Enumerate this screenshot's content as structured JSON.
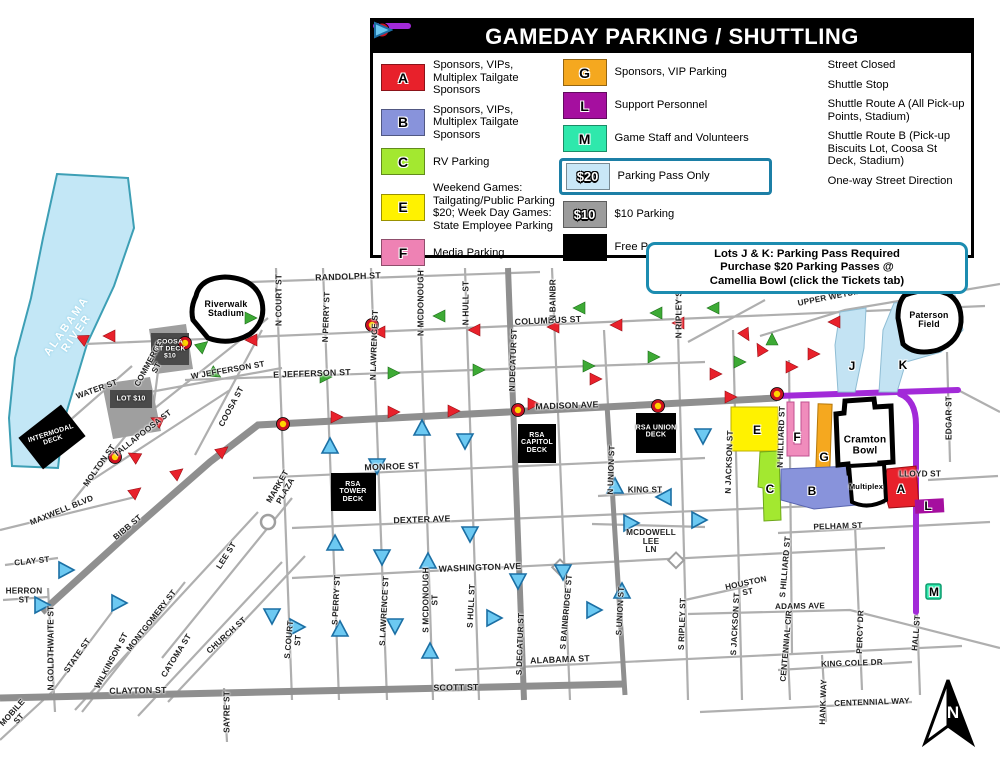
{
  "legend": {
    "title": "GAMEDAY PARKING / SHUTTLING",
    "col1": [
      {
        "letter": "A",
        "color": "#e8212b",
        "text": "Sponsors, VIPs, Multiplex Tailgate Sponsors"
      },
      {
        "letter": "B",
        "color": "#8893db",
        "text": "Sponsors, VIPs, Multiplex Tailgate Sponsors"
      },
      {
        "letter": "C",
        "color": "#a3e830",
        "text": "RV Parking"
      },
      {
        "letter": "E",
        "color": "#fff200",
        "text": "Weekend Games: Tailgating/Public Parking $20; Week Day Games: State Employee Parking"
      },
      {
        "letter": "F",
        "color": "#ee82b4",
        "text": "Media Parking"
      }
    ],
    "col2": [
      {
        "letter": "G",
        "color": "#f5a81f",
        "text": "Sponsors, VIP Parking"
      },
      {
        "letter": "L",
        "color": "#a50f9f",
        "text": "Support Personnel"
      },
      {
        "letter": "M",
        "color": "#2fe8ac",
        "text": "Game Staff and Volunteers"
      },
      {
        "letter": "$20",
        "color": "#c9e7f7",
        "text": "Parking Pass Only"
      },
      {
        "letter": "$10",
        "color": "#9c9c9c",
        "text": "$10 Parking"
      },
      {
        "letter": "",
        "color": "#000000",
        "text": "Free Public Parking"
      }
    ],
    "col3": [
      {
        "text": "Street Closed"
      },
      {
        "text": "Shuttle Stop"
      },
      {
        "text": "Shuttle Route A (All Pick-up Points, Stadium)"
      },
      {
        "text": "Shuttle Route B (Pick-up Biscuits Lot, Coosa St Deck, Stadium)"
      },
      {
        "text": "One-way Street Direction"
      }
    ]
  },
  "note": {
    "text": "Lots J & K: Parking Pass Required\nPurchase $20 Parking Passes @\nCamellia Bowl (click the Tickets tab)"
  },
  "colors": {
    "street_closed": "#a22ad8",
    "route_a": "#e8212b",
    "route_b": "#3daa35",
    "one_way": "#6cc9f2",
    "river": "#c3e7f6",
    "lot_jk": "#c3e3f3",
    "road": "#afafaf"
  },
  "streets": [
    "RANDOLPH ST",
    "COLUMBUS ST",
    "E JEFFERSON ST",
    "W JEFFERSON ST",
    "MADISON AVE",
    "MONROE ST",
    "DEXTER AVE",
    "WASHINGTON AVE",
    "ALABAMA ST",
    "SCOTT ST",
    "CLAYTON ST",
    "KING ST",
    "MCDOWELL\nLEE\nLN",
    "PELHAM ST",
    "ADAMS AVE",
    "KING COLE DR",
    "CENTENNIAL WAY",
    "LLOYD ST",
    "EDGAR ST",
    "UPPER WETUMPKA RD",
    "MAXWELL BLVD",
    "BIBB ST",
    "CLAY ST",
    "HERRON\nST",
    "MOBILE\nST",
    "STATE ST",
    "WATER ST",
    "COMMERCE\nST",
    "TALLAPOOSA ST",
    "MOLTON ST",
    "COOSA ST",
    "MONTGOMERY ST",
    "WILKINSON ST",
    "CATOMA ST",
    "CHURCH ST",
    "MARKET\nPLAZA",
    "SAYRE ST",
    "N GOLDTHWAITE ST",
    "LEE ST",
    "HOUSTON\nST",
    "CENTENNIAL CIR",
    "PERCY DR",
    "HANK WAY",
    "HALL ST",
    "N COURT ST",
    "N PERRY ST",
    "N LAWRENCE ST",
    "N MCDONOUGH",
    "N HULL ST",
    "N BAINBR",
    "N DECATUR ST",
    "N RIPLEY ST",
    "N UNION ST",
    "N JACKSON ST",
    "N HILLIARD ST",
    "S COURT\nST",
    "S PERRY ST",
    "S LAWRENCE ST",
    "S MCDONOUGH\nST",
    "S HULL ST",
    "S DECATUR ST",
    "S BAINBRIDGE ST",
    "S UNION ST",
    "S RIPLEY ST",
    "S JACKSON ST",
    "S HILLIARD ST"
  ],
  "pois": {
    "river": "ALABAMA\nRIVER",
    "riverwalk": "Riverwalk\nStadium",
    "coosa_deck": "COOSA\nST DECK\n$10",
    "lot10": "LOT $10",
    "intermodal": "INTERMODAL\nDECK",
    "rsa_capitol": "RSA\nCAPITOL\nDECK",
    "rsa_tower": "RSA\nTOWER\nDECK",
    "rsa_union": "RSA UNION\nDECK",
    "cramton": "Cramton\nBowl",
    "multiplex": "Multiplex",
    "paterson": "Paterson\nField",
    "compass": "N"
  },
  "badges": {
    "a": "A",
    "b": "B",
    "c": "C",
    "e": "E",
    "f": "F",
    "g": "G",
    "l": "L",
    "m": "M",
    "j": "J",
    "k": "K"
  }
}
